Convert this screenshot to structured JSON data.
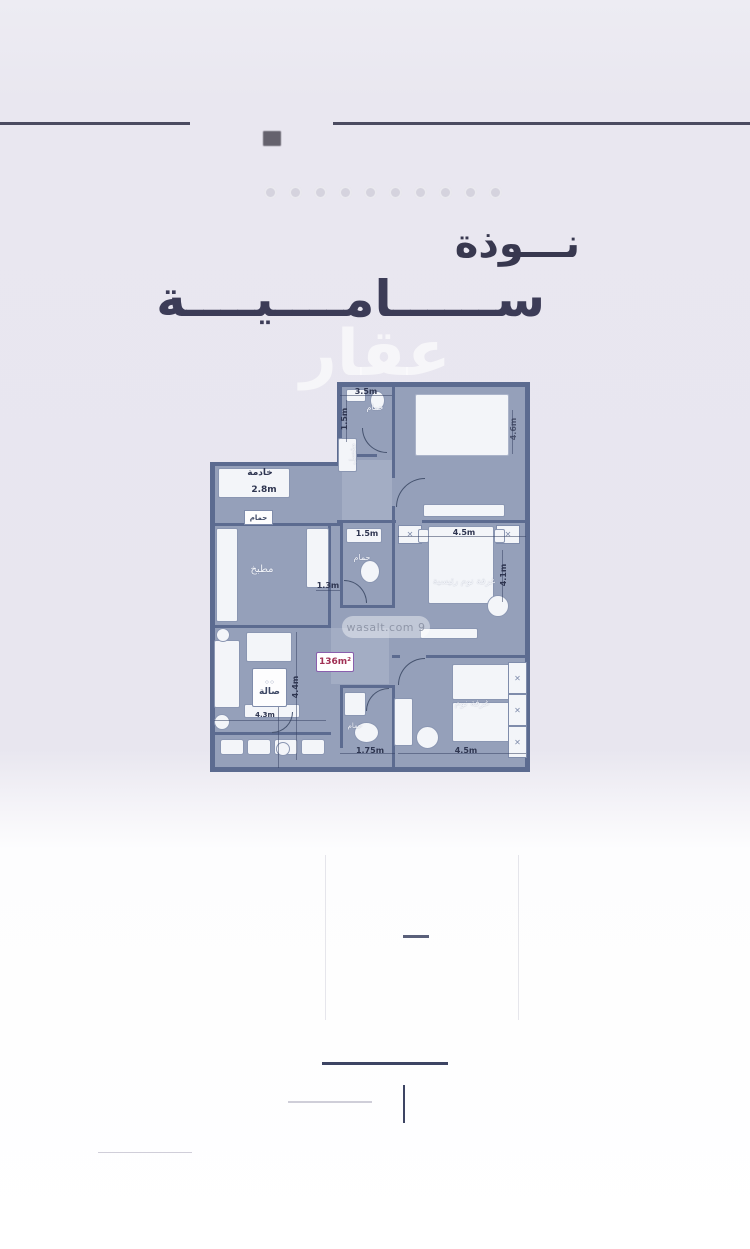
{
  "header": {
    "title_line1": "نـــوذة",
    "title_line2": "ســــــامــــيــــة",
    "brand_watermark": "عقار"
  },
  "floorplan": {
    "area_badge": "136m²",
    "site_watermark": "wasalt.com 9",
    "labels": {
      "bath_top": "حمام",
      "washbasin": "مغسل",
      "maid_room": "خادمة",
      "maid_bath": "حمام",
      "kitchen": "مطبخ",
      "bath_mid": "حمام",
      "master_bedroom": "غرفة نوم رئيسية",
      "living": "صالة",
      "bedroom": "غرفة نوم",
      "bath_bottom": "حمام"
    },
    "dimensions": {
      "top_width": "3.5m",
      "entry_height": "1.5m",
      "maid_width": "2.8m",
      "bath_mid_width": "1.5m",
      "hall_width": "1.3m",
      "master_width": "4.5m",
      "master_height": "4.1m",
      "topright_height": "4.6m",
      "living_height": "4.4m",
      "living_width": "4.3m",
      "bath_bottom_width": "1.75m",
      "bedroom_width": "4.5m"
    }
  }
}
